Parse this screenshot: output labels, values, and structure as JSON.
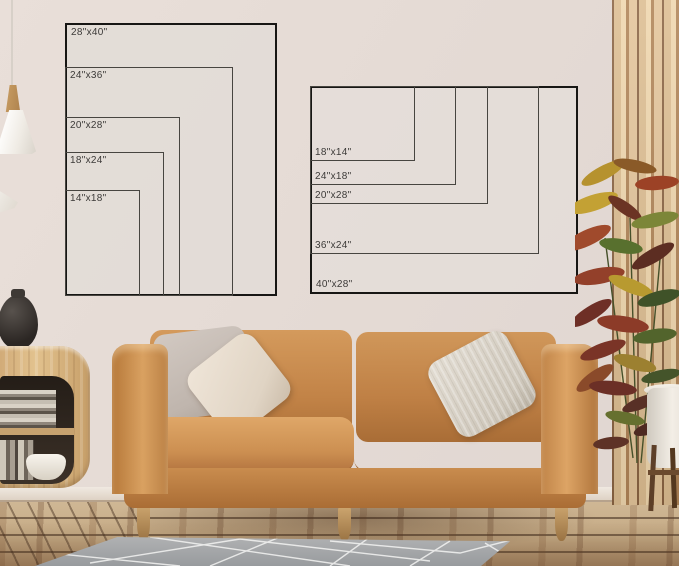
{
  "image_type": "wall-art size comparison mockup in a living room",
  "size_charts": {
    "portrait": {
      "title": "portrait poster sizes",
      "sizes": [
        "28\"x40\"",
        "24\"x36\"",
        "20\"x28\"",
        "18\"x24\"",
        "14\"x18\""
      ]
    },
    "landscape": {
      "title": "landscape poster sizes",
      "sizes": [
        "18\"x14\"",
        "24\"x18\"",
        "20\"x28\"",
        "36\"x24\"",
        "40\"x28\""
      ]
    }
  },
  "colors": {
    "wall": "#e5dbd5",
    "frame_outline": "#171614",
    "inner_outline": "#474540",
    "label_text": "#3c3a38",
    "sofa_leather": "#c28347",
    "rug": "#a3a5a7",
    "floor_wood": "#c6ab85",
    "slat_wood": "#dcbd91",
    "cabinet_wood": "#d8b57f",
    "vase": "#2b2623",
    "pot": "#f3eee6"
  }
}
